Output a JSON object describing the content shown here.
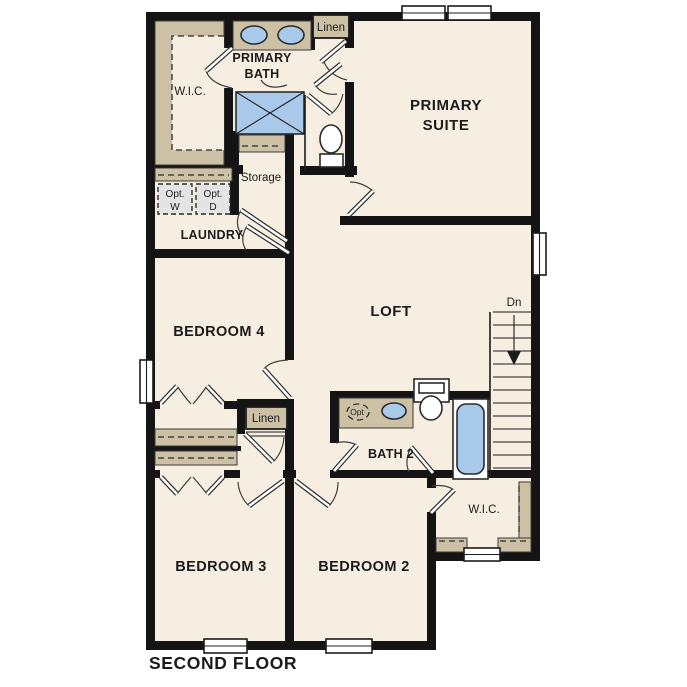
{
  "floor_name": "SECOND FLOOR",
  "colors": {
    "room_fill": "#f6eee0",
    "wall": "#141414",
    "casework_tan": "#cdc1a5",
    "fixture_blue": "#a9c9ea",
    "optional_gray": "#e4e4e4",
    "background": "#ffffff"
  },
  "rooms": {
    "primary_suite": {
      "line1": "PRIMARY",
      "line2": "SUITE"
    },
    "primary_bath": {
      "line1": "PRIMARY",
      "line2": "BATH"
    },
    "wic_primary": {
      "label": "W.I.C."
    },
    "linen_top": {
      "label": "Linen"
    },
    "storage": {
      "label": "Storage"
    },
    "laundry": {
      "label": "LAUNDRY"
    },
    "opt_washer": {
      "line1": "Opt.",
      "line2": "W"
    },
    "opt_dryer": {
      "line1": "Opt.",
      "line2": "D"
    },
    "bedroom4": {
      "label": "BEDROOM 4"
    },
    "loft": {
      "label": "LOFT"
    },
    "stairs": {
      "label": "Dn"
    },
    "linen_hall": {
      "label": "Linen"
    },
    "bath2": {
      "label": "BATH 2",
      "opt_sink": "Opt"
    },
    "wic_bedroom2": {
      "label": "W.I.C."
    },
    "bedroom3": {
      "label": "BEDROOM 3"
    },
    "bedroom2": {
      "label": "BEDROOM 2"
    }
  },
  "footer": {
    "label": "SECOND FLOOR"
  }
}
